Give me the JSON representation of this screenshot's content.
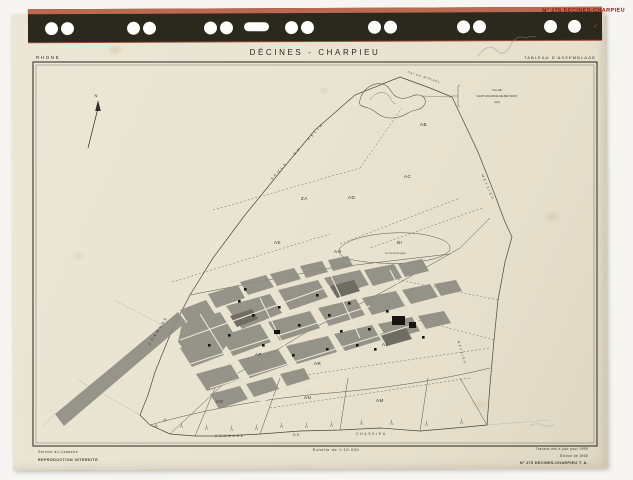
{
  "film_strip": {
    "label": "N° 275 DECINES-CHARPIEU"
  },
  "header": {
    "department": "RHONE",
    "title": "DÉCINES - CHARPIEU",
    "document_type": "TABLEAU D'ASSEMBLAGE"
  },
  "map": {
    "north_arrow": "N",
    "canal_label": "Cal DE MIRIBEL",
    "neighbor_commune_top": {
      "line1": "Cne DE",
      "line2": "SAINT-MAURICE-DE-BEYNOST",
      "line3": "(Ain)"
    },
    "neighbor_west_upper": "VAULX - EN - VELIN",
    "neighbor_west_lower": "COMMUNE",
    "neighbor_east": "MEYZIEU",
    "neighbor_southeast": "MEYZIEU",
    "boundary_south": {
      "word1": "COMMUNE",
      "word2": "DE",
      "word3": "CHASSIEU"
    },
    "lake_label": "Le Grand Large",
    "sections": [
      {
        "id": "AB"
      },
      {
        "id": "ZA"
      },
      {
        "id": "AD"
      },
      {
        "id": "AC"
      },
      {
        "id": "AE"
      },
      {
        "id": "AH"
      },
      {
        "id": "BI"
      },
      {
        "id": "AL"
      },
      {
        "id": "AP"
      },
      {
        "id": "AR"
      },
      {
        "id": "AO"
      },
      {
        "id": "AN"
      },
      {
        "id": "AM"
      }
    ]
  },
  "footer": {
    "scale": "Échelle de 1:10.000",
    "left_line1": "Service du Cadastre",
    "left_line2": "REPRODUCTION INTERDITE",
    "right_line1": "Travaux mis à jour pour 1959",
    "right_line2": "Édition de 1965",
    "right_line3": "N° 275 DECINES-CHARPIEU  T. A."
  },
  "colors": {
    "paper": "#e9e3d1",
    "film_strip": "#2b281d",
    "film_band_red": "#bb6a52",
    "stamp_red": "#92170c",
    "map_line": "#4a463e",
    "urban_gray": "#8f8d82"
  }
}
